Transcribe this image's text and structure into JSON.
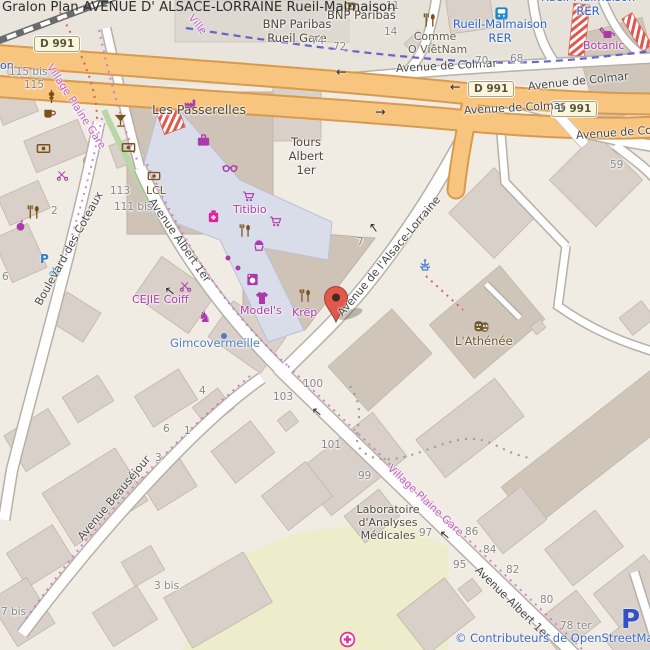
{
  "title": "Gralon Plan AVENUE D' ALSACE-LORRAINE Rueil-Malmaison",
  "attribution": "© Contributeurs de OpenStreetMap",
  "shield": "D 991",
  "glyphs": {
    "left": "←",
    "right": "→",
    "horse": "♞"
  },
  "streets": {
    "colmar": "Avenue de Colmar",
    "alsace": "Avenue de l'Alsace-Lorraine",
    "albert": "Avenue Albert 1er",
    "beausejour": "Avenue Beauséjour",
    "coteaux": "Boulevard des Coteaux",
    "village": "Village Plaine Gare",
    "village_partial": "Ville"
  },
  "places": {
    "passerelles": "Les Passerelles",
    "tours": {
      "l1": "Tours",
      "l2": "Albert",
      "l3": "1er"
    },
    "titibio": "Titibio",
    "models": "Model's",
    "krep": "Krëp",
    "cejie": "CEJIE Coiff",
    "gimco": "Gimcovermeille",
    "athenee": "L'Athénée",
    "lcl": "LCL",
    "botanic": "Botanic",
    "bnp_top": "BNP Paribas",
    "bnp_gare": {
      "l1": "BNP Paribas",
      "l2": "Rueil Gare"
    },
    "comme": {
      "l1": "Comme",
      "l2": "O ViêtNam"
    },
    "lab": {
      "l1": "Laboratoire",
      "l2": "d'Analyses",
      "l3": "Médicales"
    }
  },
  "transport": {
    "station": {
      "l1": "Rueil-Malmaison",
      "l2": "RER"
    },
    "station_partial": {
      "l1": "Rueil-Malmaison",
      "l2": "RER"
    },
    "street_cut": "on",
    "parking": "P",
    "bike_parking": "P"
  },
  "numbers": [
    "115 bis",
    "115",
    "113",
    "111 bis",
    "2",
    "6",
    "7",
    "100",
    "103",
    "101",
    "99",
    "97",
    "95",
    "86",
    "84",
    "82",
    "80",
    "78 ter",
    "3 bis",
    "7 bis",
    "4",
    "6",
    "1",
    "3",
    "14",
    "74",
    "72",
    "70",
    "68",
    "11",
    "59"
  ]
}
